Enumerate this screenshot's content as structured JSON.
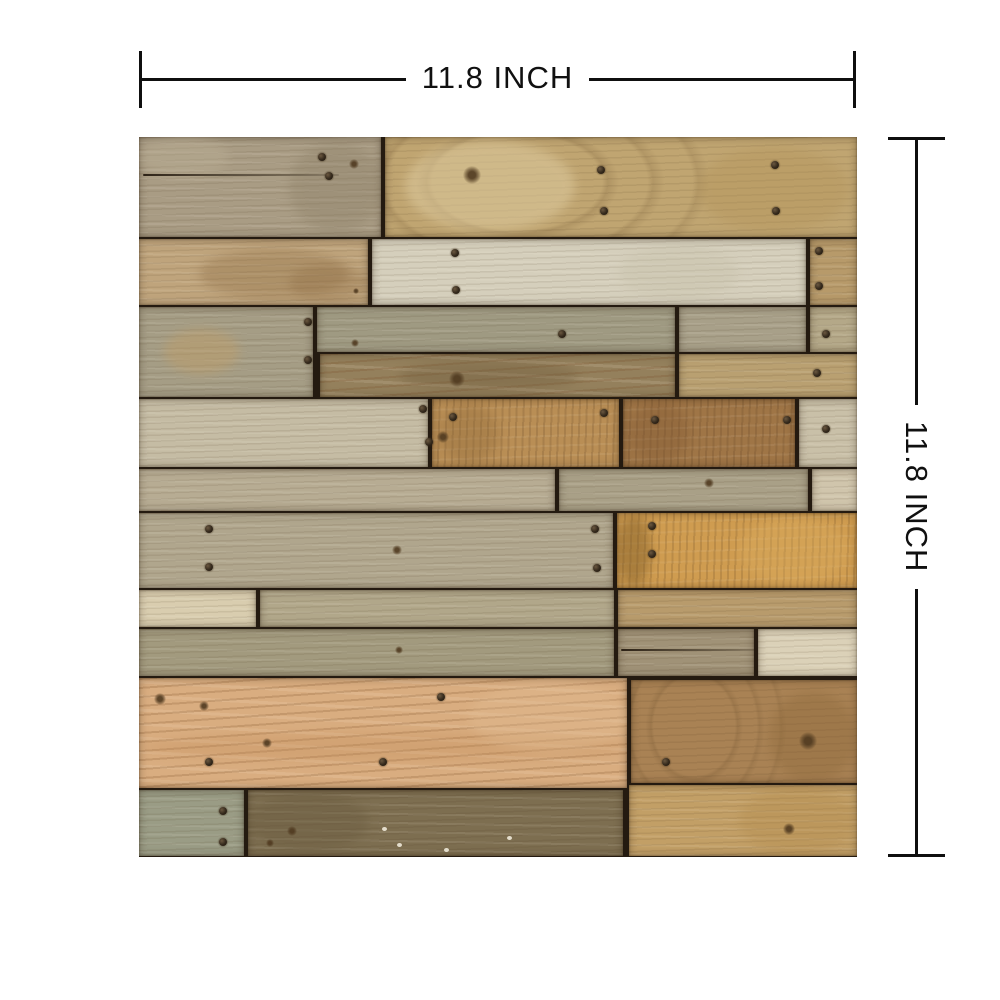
{
  "product_image": {
    "background": "#ffffff",
    "dimension_annotations": {
      "line_color": "#0f0f0f",
      "text_color": "#101010",
      "top": {
        "label": "11.8 INCH"
      },
      "right": {
        "label": "11.8 INCH"
      }
    },
    "wood_panel": {
      "description": "square sample of reclaimed weathered wood planks",
      "seam_color": "#241a10",
      "size": 718,
      "planks": [
        {
          "x": 0,
          "y": 0,
          "w": 246,
          "h": 100,
          "color": "#a99c84",
          "grain": "fine",
          "patches": [
            [
              150,
              5,
              95,
              90,
              "#8c7f66",
              0.35
            ],
            [
              0,
              0,
              90,
              40,
              "#bcb096",
              0.4
            ]
          ]
        },
        {
          "x": 246,
          "y": 0,
          "w": 472,
          "h": 100,
          "color": "#c0a571",
          "grain": "swirl",
          "patches": [
            [
              266,
              4,
              170,
              90,
              "#ddca9e",
              0.55
            ],
            [
              560,
              10,
              150,
              85,
              "#b29257",
              0.35
            ]
          ]
        },
        {
          "x": 0,
          "y": 102,
          "w": 233,
          "h": 66,
          "color": "#bfa47c",
          "grain": "fine",
          "patches": [
            [
              60,
              112,
              150,
              50,
              "#8e6e45",
              0.35
            ],
            [
              150,
              127,
              80,
              38,
              "#8a683f",
              0.3
            ]
          ]
        },
        {
          "x": 233,
          "y": 102,
          "w": 438,
          "h": 66,
          "color": "#d5cfbc",
          "grain": "fine",
          "patches": [
            [
              480,
              108,
              120,
              55,
              "#c5bfa8",
              0.35
            ]
          ]
        },
        {
          "x": 671,
          "y": 102,
          "w": 47,
          "h": 66,
          "color": "#b79a6a",
          "grain": "fine"
        },
        {
          "x": 0,
          "y": 170,
          "w": 178,
          "h": 90,
          "color": "#a59d85",
          "grain": "fine",
          "patches": [
            [
              25,
              192,
              75,
              45,
              "#c09d66",
              0.45
            ]
          ]
        },
        {
          "x": 178,
          "y": 170,
          "w": 362,
          "h": 45,
          "color": "#9f9a82",
          "grain": "fine"
        },
        {
          "x": 540,
          "y": 170,
          "w": 131,
          "h": 45,
          "color": "#a8a089",
          "grain": "fine"
        },
        {
          "x": 671,
          "y": 170,
          "w": 47,
          "h": 45,
          "color": "#b4a888",
          "grain": "fine"
        },
        {
          "x": 181,
          "y": 217,
          "w": 359,
          "h": 43,
          "color": "#94805c",
          "grain": "wavy",
          "patches": [
            [
              260,
              224,
              180,
              30,
              "#6e5a3a",
              0.35
            ]
          ]
        },
        {
          "x": 540,
          "y": 217,
          "w": 178,
          "h": 43,
          "color": "#b9a071",
          "grain": "fine"
        },
        {
          "x": 0,
          "y": 262,
          "w": 293,
          "h": 68,
          "color": "#c5bca4",
          "grain": "fine"
        },
        {
          "x": 293,
          "y": 262,
          "w": 191,
          "h": 68,
          "color": "#b98e55",
          "grain": "vert",
          "patches": [
            [
              300,
              268,
              60,
              58,
              "#8a6536",
              0.3
            ]
          ]
        },
        {
          "x": 484,
          "y": 262,
          "w": 176,
          "h": 68,
          "color": "#9f7546",
          "grain": "vert",
          "patches": [
            [
              490,
              266,
              60,
              60,
              "#7e5530",
              0.3
            ]
          ]
        },
        {
          "x": 660,
          "y": 262,
          "w": 58,
          "h": 68,
          "color": "#c9c0a8",
          "grain": "fine"
        },
        {
          "x": 0,
          "y": 332,
          "w": 420,
          "h": 42,
          "color": "#b7ac93",
          "grain": "fine"
        },
        {
          "x": 420,
          "y": 332,
          "w": 253,
          "h": 42,
          "color": "#a9a087",
          "grain": "fine"
        },
        {
          "x": 673,
          "y": 332,
          "w": 45,
          "h": 42,
          "color": "#d0c5ac",
          "grain": "fine"
        },
        {
          "x": 0,
          "y": 376,
          "w": 478,
          "h": 75,
          "color": "#b0a68d",
          "grain": "fine"
        },
        {
          "x": 478,
          "y": 376,
          "w": 240,
          "h": 75,
          "color": "#cf9c50",
          "grain": "vert",
          "patches": [
            [
              478,
              378,
              34,
              71,
              "#7c5a26",
              0.45
            ],
            [
              600,
              380,
              110,
              68,
              "#dcae60",
              0.35
            ]
          ]
        },
        {
          "x": 0,
          "y": 453,
          "w": 121,
          "h": 37,
          "color": "#d9cdaf",
          "grain": "fine"
        },
        {
          "x": 121,
          "y": 453,
          "w": 358,
          "h": 37,
          "color": "#b1a78a",
          "grain": "fine"
        },
        {
          "x": 479,
          "y": 453,
          "w": 239,
          "h": 37,
          "color": "#b89b6c",
          "grain": "fine"
        },
        {
          "x": 0,
          "y": 492,
          "w": 479,
          "h": 47,
          "color": "#a29a7e",
          "grain": "fine"
        },
        {
          "x": 479,
          "y": 492,
          "w": 140,
          "h": 47,
          "color": "#a09277",
          "grain": "fine"
        },
        {
          "x": 619,
          "y": 492,
          "w": 99,
          "h": 47,
          "color": "#dbd1b8",
          "grain": "fine"
        },
        {
          "x": 0,
          "y": 541,
          "w": 492,
          "h": 110,
          "color": "#d9ad80",
          "grain": "wavy",
          "patches": [
            [
              0,
              595,
              490,
              30,
              "#c28c58",
              0.3
            ],
            [
              330,
              545,
              160,
              70,
              "#e2bd93",
              0.35
            ]
          ]
        },
        {
          "x": 492,
          "y": 543,
          "w": 226,
          "h": 103,
          "color": "#a98254",
          "grain": "swirl",
          "patches": [
            [
              630,
              555,
              88,
              90,
              "#8a6638",
              0.35
            ]
          ]
        },
        {
          "x": 0,
          "y": 653,
          "w": 109,
          "h": 66,
          "color": "#9a9c85",
          "grain": "fine"
        },
        {
          "x": 109,
          "y": 653,
          "w": 379,
          "h": 66,
          "color": "#7d6e50",
          "grain": "fine",
          "patches": [
            [
              110,
              655,
              120,
              60,
              "#6a5b3f",
              0.4
            ]
          ]
        },
        {
          "x": 490,
          "y": 648,
          "w": 228,
          "h": 71,
          "color": "#c29f66",
          "grain": "fine",
          "patches": [
            [
              600,
              650,
              118,
              68,
              "#b08748",
              0.3
            ]
          ]
        }
      ],
      "nails": [
        [
          183,
          20
        ],
        [
          190,
          39
        ],
        [
          462,
          33
        ],
        [
          465,
          74
        ],
        [
          636,
          28
        ],
        [
          637,
          74
        ],
        [
          316,
          116
        ],
        [
          317,
          153
        ],
        [
          680,
          114
        ],
        [
          680,
          149
        ],
        [
          169,
          185
        ],
        [
          169,
          223
        ],
        [
          423,
          197
        ],
        [
          687,
          197
        ],
        [
          678,
          236
        ],
        [
          284,
          272
        ],
        [
          290,
          305
        ],
        [
          314,
          280
        ],
        [
          465,
          276
        ],
        [
          516,
          283
        ],
        [
          648,
          283
        ],
        [
          687,
          292
        ],
        [
          70,
          392
        ],
        [
          70,
          430
        ],
        [
          456,
          392
        ],
        [
          458,
          431
        ],
        [
          513,
          389
        ],
        [
          513,
          417
        ],
        [
          302,
          560
        ],
        [
          70,
          625
        ],
        [
          244,
          625
        ],
        [
          527,
          625
        ],
        [
          84,
          674
        ],
        [
          84,
          705
        ]
      ],
      "knots": [
        [
          215,
          27,
          5
        ],
        [
          333,
          38,
          9
        ],
        [
          217,
          154,
          3
        ],
        [
          216,
          206,
          4
        ],
        [
          318,
          242,
          8
        ],
        [
          304,
          300,
          6
        ],
        [
          570,
          346,
          5
        ],
        [
          258,
          413,
          5
        ],
        [
          260,
          513,
          4
        ],
        [
          21,
          562,
          6
        ],
        [
          65,
          569,
          5
        ],
        [
          128,
          606,
          5
        ],
        [
          669,
          604,
          9
        ],
        [
          153,
          694,
          5
        ],
        [
          131,
          706,
          4
        ],
        [
          650,
          692,
          6
        ]
      ],
      "cracks": [
        [
          4,
          37,
          196
        ],
        [
          482,
          512,
          134
        ]
      ],
      "specks": [
        [
          258,
          706
        ],
        [
          243,
          690
        ],
        [
          305,
          711
        ],
        [
          368,
          699
        ]
      ]
    }
  }
}
